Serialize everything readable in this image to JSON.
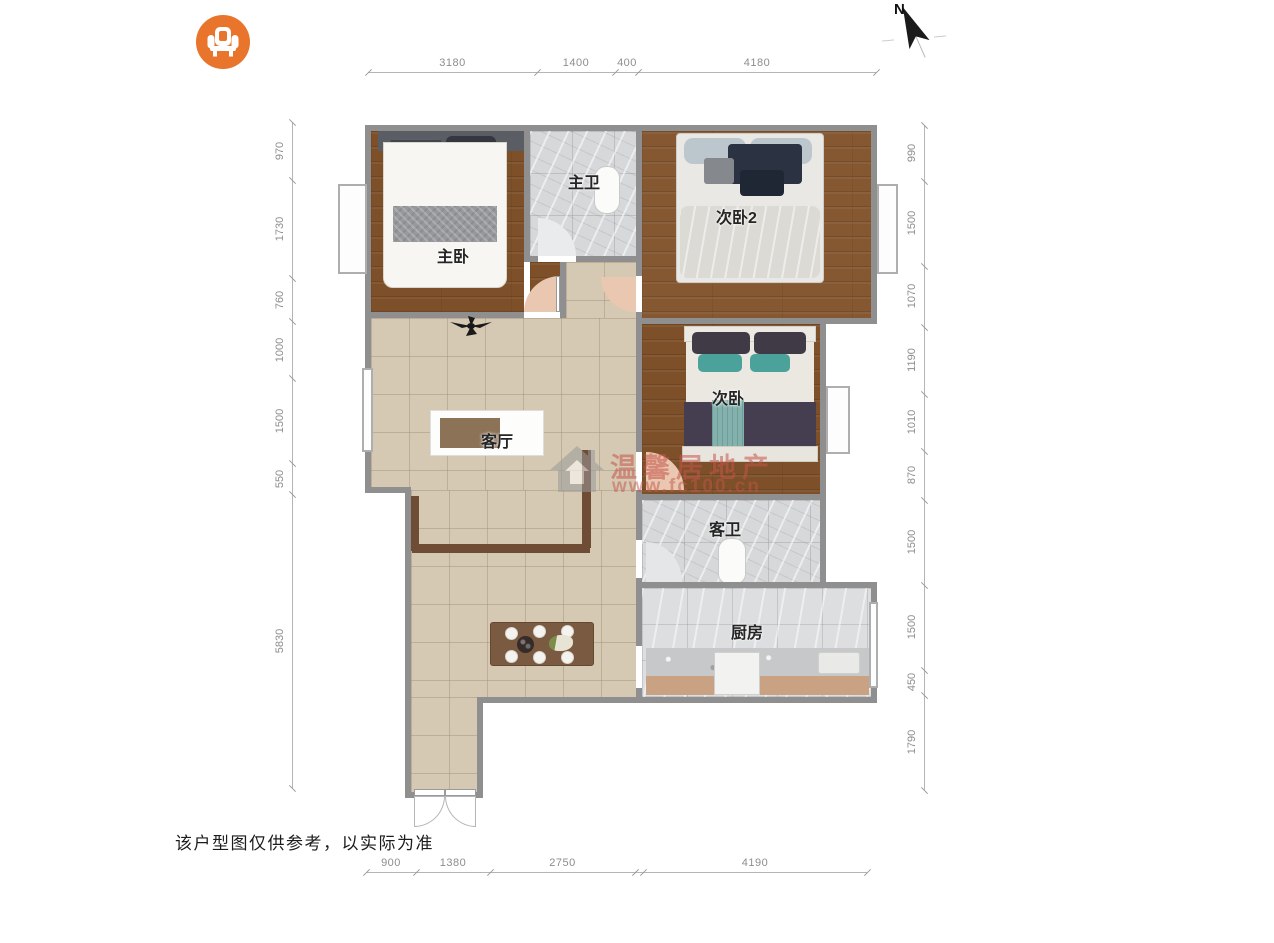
{
  "logo": {
    "icon": "armchair-icon",
    "color": "#e8752b"
  },
  "compass": {
    "label": "N"
  },
  "rooms": {
    "master_bedroom": "主卧",
    "master_bath": "主卫",
    "bedroom2": "次卧2",
    "bedroom": "次卧",
    "living": "客厅",
    "guest_bath": "客卫",
    "kitchen": "厨房"
  },
  "dimensions": {
    "top": [
      "3180",
      "1400",
      "400",
      "4180"
    ],
    "bottom": [
      "900",
      "1380",
      "2750",
      "4190"
    ],
    "left": [
      "970",
      "1730",
      "760",
      "1000",
      "1500",
      "550",
      "5830"
    ],
    "right": [
      "990",
      "1500",
      "1070",
      "1190",
      "1010",
      "870",
      "1500",
      "1500",
      "450",
      "1790"
    ]
  },
  "watermark": {
    "brand": "温馨居地产",
    "url": "www.fc100.cn"
  },
  "disclaimer": "该户型图仅供参考，以实际为准",
  "colors": {
    "wall": "#8f8f8f",
    "wood": "#7d5029",
    "tile": "#d5c9b3",
    "marble": "#d6d8da",
    "door_arc": "#e9c7b0",
    "teal_accent": "#4ba29b",
    "navy_accent": "#2b3343",
    "watermark_red": "#c4544a"
  }
}
